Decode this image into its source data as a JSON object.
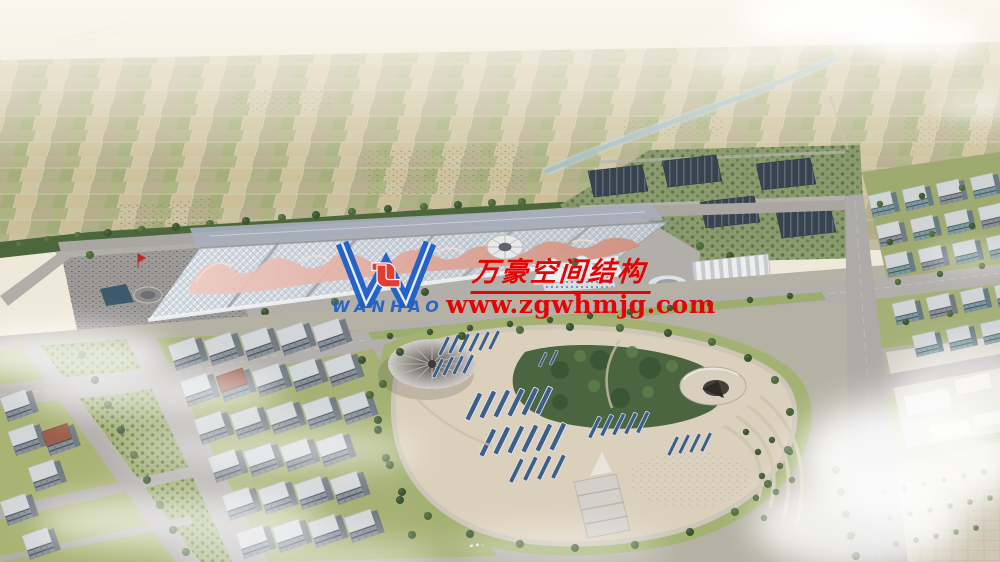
{
  "title": "Aerial rendering of exhibition center complex",
  "watermark": {
    "logo_text": "WANHAO",
    "company_name_cn": "万豪空间结构",
    "website": "www.zgwhmjg.com",
    "text_red": "#e30505",
    "logo_blue": "#1d5ec6",
    "logo_accent_red": "#e2382c"
  },
  "scene": {
    "palette": {
      "sky_haze": "#f6f1e8",
      "farmland_tan": "#c6bd9d",
      "field_green": "#a9b07c",
      "tree_green": "#4e6a3c",
      "hall_roof": "#d4dbe2",
      "canopy_pink": "#d7978a",
      "solar_navy": "#3f5f86",
      "plaza_beige": "#d8cdb9",
      "lawn_green": "#a7b175",
      "road_gray": "#b3afac",
      "facade_gray": "#89929a",
      "water_blue": "#a4c0c6"
    }
  }
}
